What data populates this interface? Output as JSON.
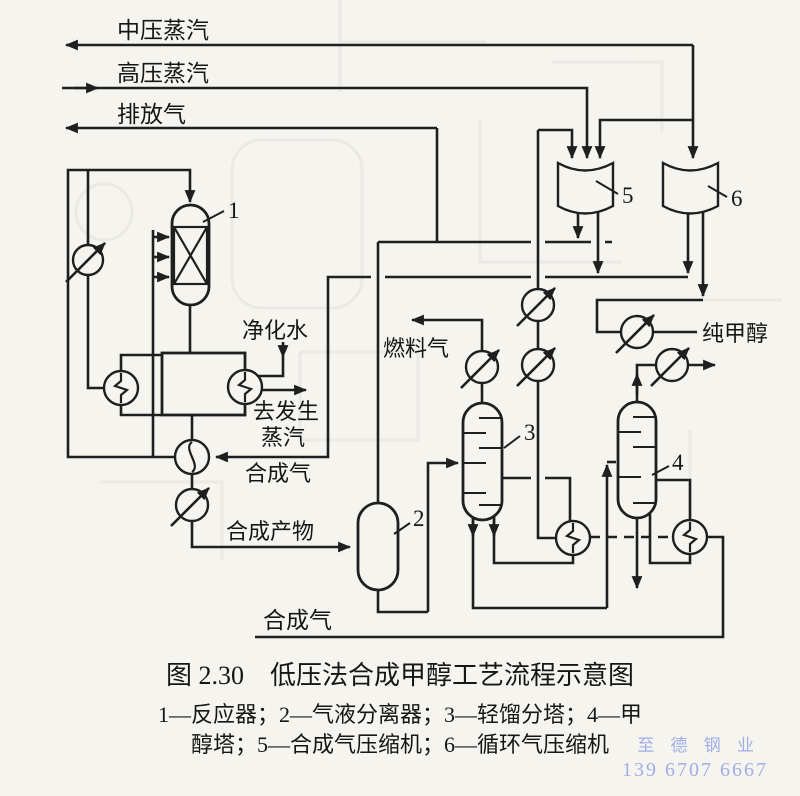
{
  "figure": {
    "caption": "图 2.30　低压法合成甲醇工艺流程示意图",
    "legend_line1": "1—反应器；2—气液分离器；3—轻馏分塔；4—甲",
    "legend_line2": "醇塔；5—合成气压缩机；6—循环气压缩机"
  },
  "stream_labels": {
    "mp_steam": "中压蒸汽",
    "hp_steam": "高压蒸汽",
    "vent_gas": "排放气",
    "purified_water": "净化水",
    "to_steam_gen_1": "去发生",
    "to_steam_gen_2": "蒸汽",
    "syngas_recycle": "合成气",
    "synthesis_product": "合成产物",
    "fuel_gas": "燃料气",
    "pure_methanol": "纯甲醇",
    "syngas_feed": "合成气"
  },
  "equipment_numbers": {
    "reactor": "1",
    "separator": "2",
    "light_ends_column": "3",
    "methanol_column": "4",
    "syngas_compressor": "5",
    "recycle_compressor": "6"
  },
  "watermark": {
    "line1": "至 德 钢 业",
    "line2": "139 6707 6667",
    "color": "#93a2e6"
  },
  "colors": {
    "ink": "#1f1f1f",
    "paper": "#f5f4ef"
  }
}
